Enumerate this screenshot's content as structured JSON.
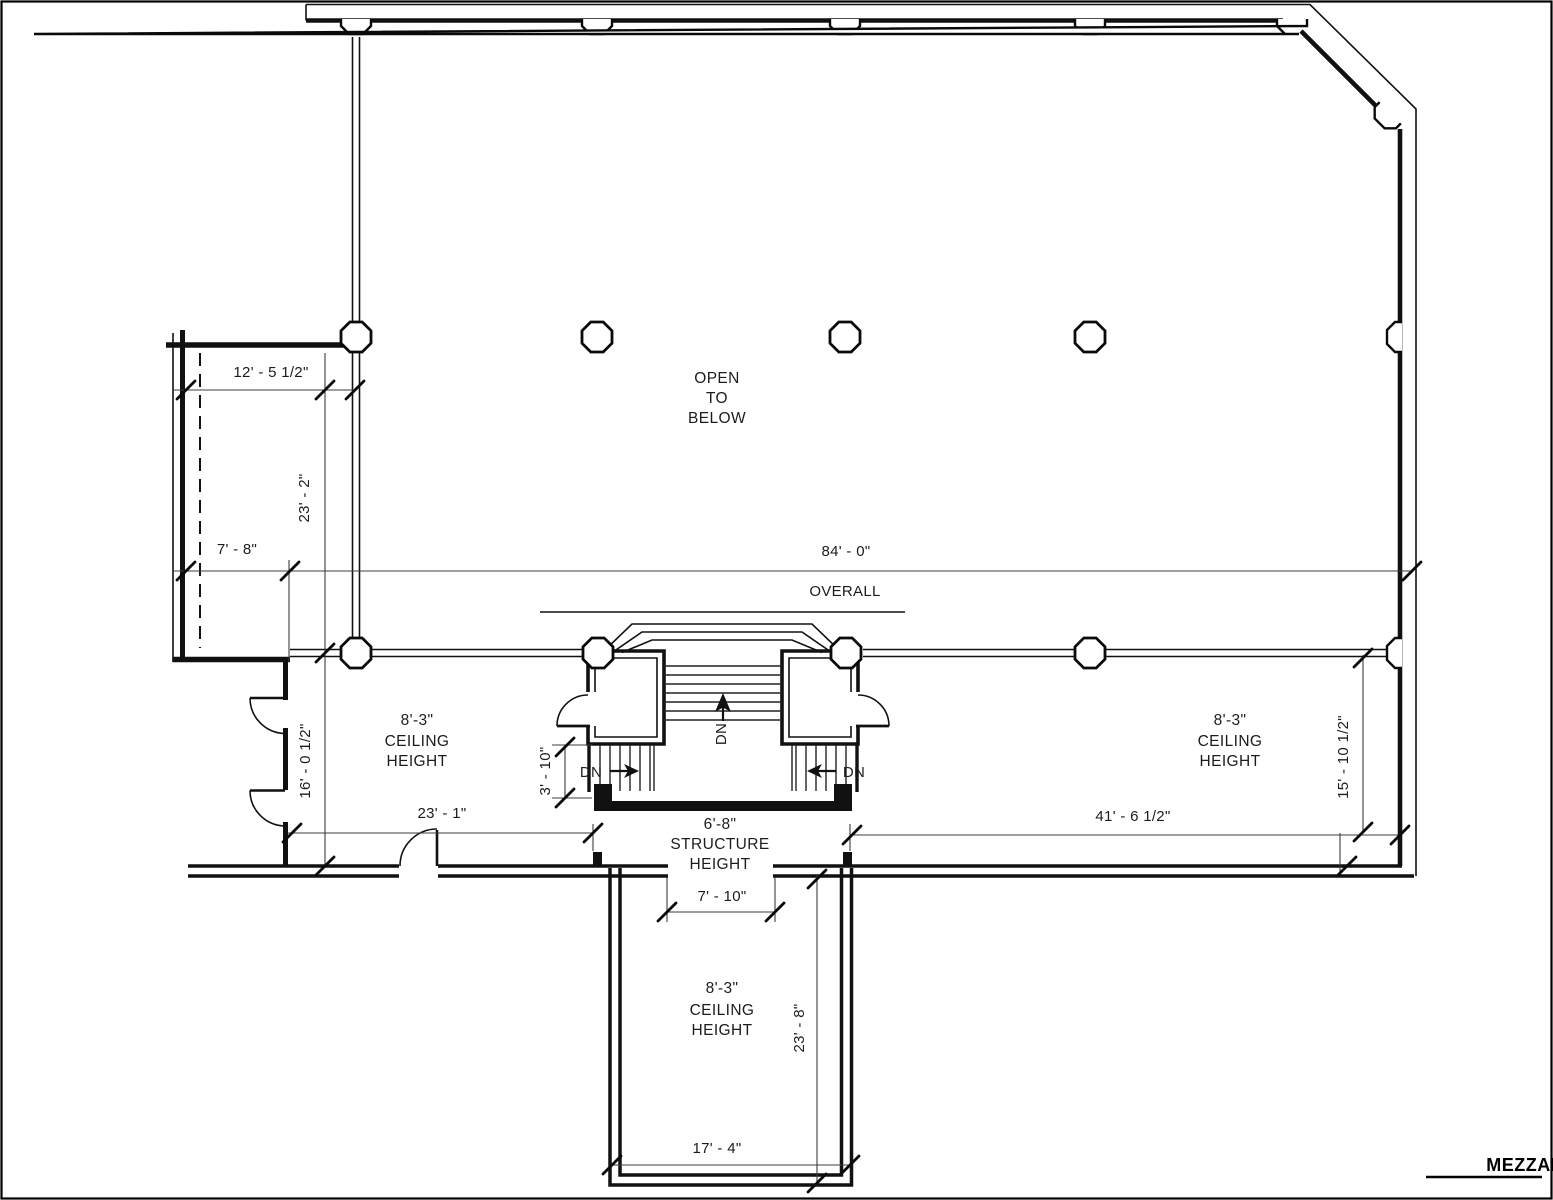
{
  "sheet": {
    "title": "MEZZANINE",
    "open_area": {
      "line1": "OPEN",
      "line2": "TO",
      "line3": "BELOW"
    },
    "overall": {
      "value": "84' - 0\"",
      "label": "OVERALL"
    },
    "dims": {
      "wing_width": "12' - 5 1/2\"",
      "wing_height": "23' - 2\"",
      "wing_offset": "7' - 8\"",
      "left_room_height": "16' - 0 1/2\"",
      "left_room_width": "23' - 1\"",
      "side_stair": "3' - 10\"",
      "stair_opening": "7' - 10\"",
      "right_room_width": "41' - 6 1/2\"",
      "right_room_depth": "15' - 10 1/2\"",
      "bottom_room_depth": "23' - 8\"",
      "bottom_room_width": "17' - 4\""
    },
    "rooms": {
      "left": {
        "height": "8'-3\"",
        "l1": "CEILING",
        "l2": "HEIGHT"
      },
      "right": {
        "height": "8'-3\"",
        "l1": "CEILING",
        "l2": "HEIGHT"
      },
      "bottom": {
        "height": "8'-3\"",
        "l1": "CEILING",
        "l2": "HEIGHT"
      },
      "stair_core": {
        "height": "6'-8\"",
        "l1": "STRUCTURE",
        "l2": "HEIGHT"
      }
    },
    "stairs": {
      "dn_center": "DN",
      "dn_left": "DN",
      "dn_right": "DN"
    }
  }
}
